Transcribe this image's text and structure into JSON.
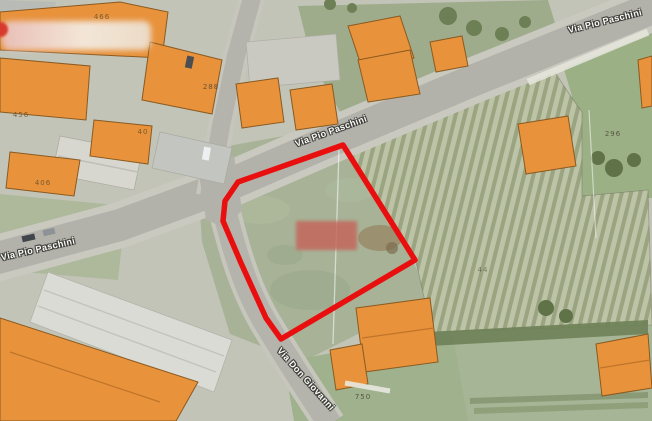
{
  "streets": [
    "Via Pio Paschini",
    "Via Pio Paschini",
    "Via Pio Paschini",
    "Via Don Giovanni"
  ],
  "parcel_numbers": [
    "466",
    "288",
    "456",
    "40",
    "406",
    "296",
    "44",
    "750"
  ],
  "highlight": {
    "selected_parcel_outline_color": "#E90F0F",
    "outline_width_px": 5.5
  },
  "redactions": [
    {
      "id": "building-label-blur-top-left",
      "color": "#EFD9D3"
    },
    {
      "id": "parcel-label-blur-center",
      "color": "#C4685C"
    }
  ],
  "palette": {
    "building_fill": "#E8923C",
    "building_stroke": "#8A5A20",
    "road": "#B3B2AA",
    "grass": "#A7B296",
    "vineyard_light": "#BCC3A6",
    "vineyard_dark": "#9AA480",
    "lawn": "#9FB18D"
  }
}
